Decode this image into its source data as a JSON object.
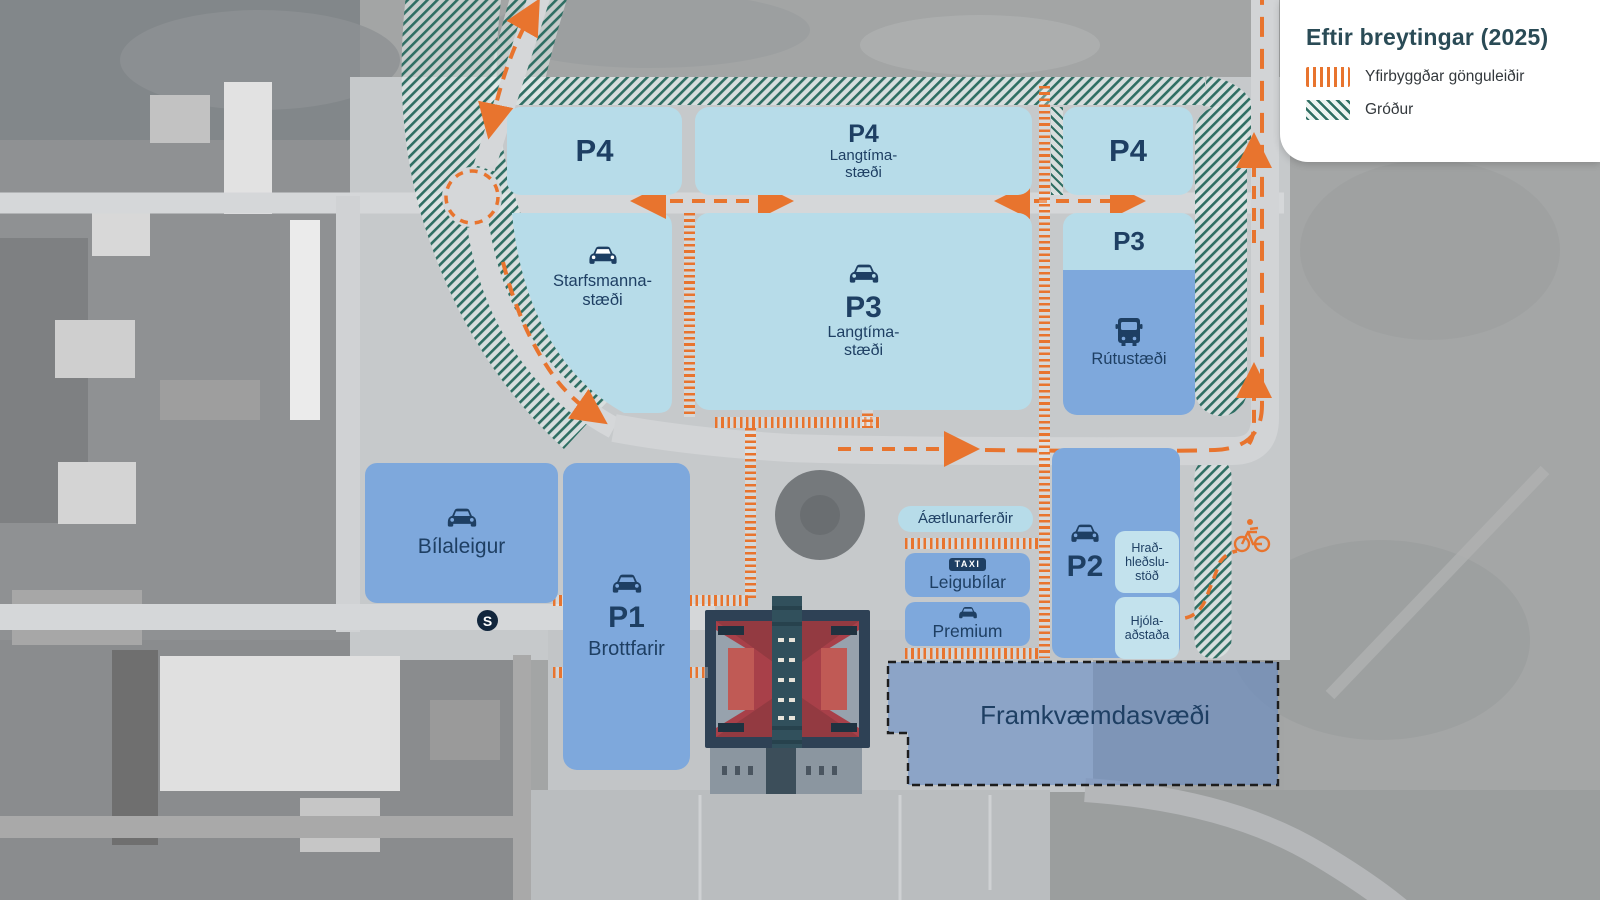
{
  "legend": {
    "title": "Eftir breytingar (2025)",
    "items": [
      {
        "swatch": "orange-stripes",
        "label": "Yfirbyggðar gönguleiðir"
      },
      {
        "swatch": "green-hatch",
        "label": "Gróður"
      }
    ]
  },
  "zones": {
    "p4_left": {
      "code": "P4"
    },
    "p4_mid": {
      "code": "P4",
      "sub1": "Langtíma-",
      "sub2": "stæði"
    },
    "p4_right": {
      "code": "P4"
    },
    "staff": {
      "line1": "Starfsmanna-",
      "line2": "stæði",
      "icon": "car-icon"
    },
    "p3_mid": {
      "code": "P3",
      "sub1": "Langtíma-",
      "sub2": "stæði",
      "icon": "car-icon"
    },
    "p3_right": {
      "code": "P3"
    },
    "bus": {
      "label": "Rútustæði",
      "icon": "bus-icon"
    },
    "rental": {
      "label": "Bílaleigur",
      "icon": "car-icon"
    },
    "p1": {
      "code": "P1",
      "label": "Brottfarir",
      "icon": "car-icon"
    },
    "schedule": {
      "label": "Áætlunarferðir"
    },
    "taxi": {
      "label": "Leigubílar",
      "badge": "TAXI"
    },
    "premium": {
      "label": "Premium",
      "icon": "car-icon"
    },
    "p2": {
      "code": "P2",
      "icon": "car-icon"
    },
    "charging": {
      "line1": "Hrað-",
      "line2": "hleðslu-",
      "line3": "stöð"
    },
    "bike_facility": {
      "line1": "Hjóla-",
      "line2": "aðstaða"
    },
    "construction": {
      "label": "Framkvæmdasvæði"
    }
  },
  "markers": {
    "stop_badge": "S",
    "bike_route_icon": "bicycle-icon"
  },
  "colors": {
    "zone_pale_blue": "#b7dce9",
    "zone_medium_blue": "#7ea8dc",
    "label_navy": "#1e3f63",
    "walkway_orange": "#e8742e",
    "vegetation_teal": "#2f6e63",
    "construction_blue": "#6088c7",
    "legend_title": "#2a4b56"
  }
}
